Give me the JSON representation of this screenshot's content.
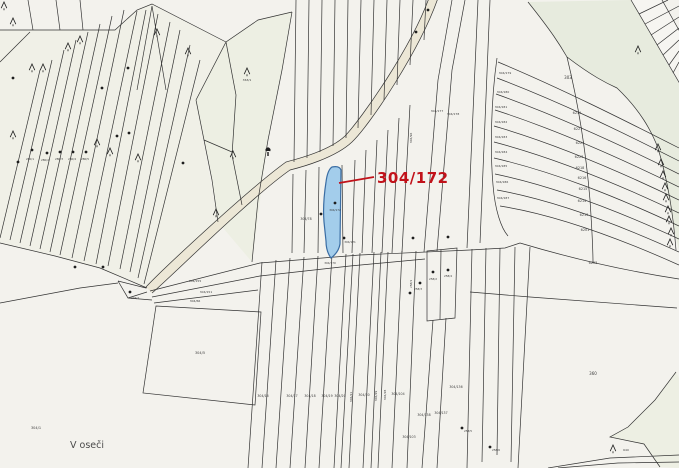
{
  "map": {
    "type": "cadastral-parcel-map",
    "place_label": "V oseči",
    "highlight": {
      "label": "304/172",
      "label_color": "#c1121a",
      "parcel_fill": "#a3cdeb",
      "parcel_stroke": "#3a6da3"
    },
    "colors": {
      "background": "#f3f2ed",
      "line": "#333333",
      "tint_green": "#e7ebde",
      "tint_green_light": "#edefe3",
      "tint_paper": "#f0f0e7",
      "road_fill": "#ece7d6",
      "label_color": "#3c3c3c"
    },
    "symbols": {
      "conifer_tree_icon": [
        [
          4,
          6
        ],
        [
          13,
          22
        ],
        [
          32,
          68
        ],
        [
          43,
          68
        ],
        [
          68,
          47
        ],
        [
          80,
          40
        ],
        [
          157,
          33
        ],
        [
          188,
          52
        ],
        [
          13,
          135
        ],
        [
          97,
          143
        ],
        [
          110,
          152
        ],
        [
          138,
          158
        ],
        [
          216,
          213
        ],
        [
          233,
          155
        ],
        [
          638,
          50
        ],
        [
          658,
          148
        ],
        [
          661,
          163
        ],
        [
          663,
          175
        ],
        [
          665,
          187
        ],
        [
          666,
          198
        ],
        [
          668,
          210
        ],
        [
          669,
          220
        ],
        [
          671,
          232
        ],
        [
          670,
          243
        ],
        [
          613,
          449
        ],
        [
          247,
          72
        ]
      ],
      "deciduous_tree_icon": [
        [
          268,
          152
        ]
      ],
      "boundary_dots": [
        [
          13,
          78
        ],
        [
          102,
          88
        ],
        [
          128,
          68
        ],
        [
          117,
          136
        ],
        [
          129,
          133
        ],
        [
          32,
          150
        ],
        [
          47,
          153
        ],
        [
          60,
          152
        ],
        [
          73,
          152
        ],
        [
          86,
          152
        ],
        [
          18,
          162
        ],
        [
          183,
          163
        ],
        [
          75,
          267
        ],
        [
          103,
          267
        ],
        [
          335,
          203
        ],
        [
          321,
          214
        ],
        [
          344,
          238
        ],
        [
          413,
          238
        ],
        [
          448,
          237
        ],
        [
          433,
          272
        ],
        [
          448,
          270
        ],
        [
          420,
          283
        ],
        [
          410,
          293
        ],
        [
          130,
          292
        ],
        [
          462,
          428
        ],
        [
          490,
          447
        ],
        [
          428,
          10
        ],
        [
          416,
          32
        ]
      ]
    },
    "parcel_labels": [
      {
        "t": "303",
        "x": 568,
        "y": 79,
        "s": 4
      },
      {
        "t": "6219",
        "x": 577,
        "y": 114,
        "s": 3.4
      },
      {
        "t": "6227",
        "x": 578,
        "y": 130,
        "s": 3.4
      },
      {
        "t": "6224",
        "x": 580,
        "y": 144,
        "s": 3.4
      },
      {
        "t": "6223",
        "x": 579,
        "y": 158,
        "s": 3.4
      },
      {
        "t": "6218",
        "x": 580,
        "y": 169,
        "s": 3.4
      },
      {
        "t": "6216",
        "x": 582,
        "y": 179,
        "s": 3.4
      },
      {
        "t": "6215",
        "x": 583,
        "y": 190,
        "s": 3.4
      },
      {
        "t": "6214",
        "x": 582,
        "y": 202,
        "s": 3.4
      },
      {
        "t": "6213",
        "x": 584,
        "y": 216,
        "s": 3.4
      },
      {
        "t": "6201",
        "x": 585,
        "y": 231,
        "s": 3.4
      },
      {
        "t": "6203",
        "x": 593,
        "y": 264,
        "s": 3.4
      },
      {
        "t": "304/179",
        "x": 505,
        "y": 74,
        "s": 3
      },
      {
        "t": "304/180",
        "x": 503,
        "y": 93,
        "s": 3
      },
      {
        "t": "304/181",
        "x": 501,
        "y": 108,
        "s": 3
      },
      {
        "t": "304/182",
        "x": 501,
        "y": 123,
        "s": 3
      },
      {
        "t": "304/183",
        "x": 501,
        "y": 138,
        "s": 3
      },
      {
        "t": "304/184",
        "x": 501,
        "y": 153,
        "s": 3
      },
      {
        "t": "304/185",
        "x": 501,
        "y": 167,
        "s": 3
      },
      {
        "t": "304/186",
        "x": 502,
        "y": 183,
        "s": 3
      },
      {
        "t": "304/187",
        "x": 503,
        "y": 199,
        "s": 3
      },
      {
        "t": "304/177",
        "x": 437,
        "y": 112,
        "s": 3
      },
      {
        "t": "304/178",
        "x": 453,
        "y": 115,
        "s": 3
      },
      {
        "t": "304/96",
        "x": 412,
        "y": 138,
        "s": 3,
        "r": -90
      },
      {
        "t": "304/16",
        "x": 263,
        "y": 397,
        "s": 3.2
      },
      {
        "t": "304/17",
        "x": 292,
        "y": 397,
        "s": 3.2
      },
      {
        "t": "304/18",
        "x": 310,
        "y": 397,
        "s": 3.2
      },
      {
        "t": "304/19",
        "x": 327,
        "y": 397,
        "s": 3.2
      },
      {
        "t": "304/20",
        "x": 340,
        "y": 397,
        "s": 3.2
      },
      {
        "t": "304/21",
        "x": 352,
        "y": 397,
        "s": 3,
        "r": -90
      },
      {
        "t": "304/30",
        "x": 364,
        "y": 396,
        "s": 3.2
      },
      {
        "t": "304/29",
        "x": 377,
        "y": 396,
        "s": 3,
        "r": -90
      },
      {
        "t": "304/28",
        "x": 386,
        "y": 395,
        "s": 3,
        "r": -90
      },
      {
        "t": "304/104",
        "x": 398,
        "y": 395,
        "s": 3.2
      },
      {
        "t": "304/136",
        "x": 456,
        "y": 388,
        "s": 3.2
      },
      {
        "t": "304/138",
        "x": 424,
        "y": 416,
        "s": 3.2
      },
      {
        "t": "304/137",
        "x": 441,
        "y": 414,
        "s": 3.2
      },
      {
        "t": "304/103",
        "x": 409,
        "y": 438,
        "s": 3.2
      },
      {
        "t": "258/2",
        "x": 433,
        "y": 280,
        "s": 2.8
      },
      {
        "t": "258/4",
        "x": 448,
        "y": 277,
        "s": 2.8
      },
      {
        "t": "258/3",
        "x": 418,
        "y": 290,
        "s": 2.8
      },
      {
        "t": "258/1",
        "x": 412,
        "y": 284,
        "s": 2.8,
        "r": -90
      },
      {
        "t": "258/5",
        "x": 468,
        "y": 432,
        "s": 2.8
      },
      {
        "t": "258/6",
        "x": 496,
        "y": 451,
        "s": 2.8
      },
      {
        "t": "304/155",
        "x": 195,
        "y": 282,
        "s": 3
      },
      {
        "t": "304/151",
        "x": 206,
        "y": 293,
        "s": 3
      },
      {
        "t": "304/66",
        "x": 195,
        "y": 302,
        "s": 3
      },
      {
        "t": "304/7",
        "x": 135,
        "y": 299,
        "s": 2.8
      },
      {
        "t": "304/5",
        "x": 200,
        "y": 354,
        "s": 3.5
      },
      {
        "t": "304/1",
        "x": 36,
        "y": 429,
        "s": 3.5
      },
      {
        "t": "360",
        "x": 593,
        "y": 375,
        "s": 4
      },
      {
        "t": "640",
        "x": 626,
        "y": 451,
        "s": 3
      },
      {
        "t": "363/1",
        "x": 247,
        "y": 81,
        "s": 3
      },
      {
        "t": "304/78",
        "x": 306,
        "y": 220,
        "s": 3.2
      },
      {
        "t": "304/172",
        "x": 335,
        "y": 211,
        "s": 2.8
      },
      {
        "t": "304/170",
        "x": 330,
        "y": 264,
        "s": 2.8
      },
      {
        "t": "304/171",
        "x": 350,
        "y": 243,
        "s": 2.8
      },
      {
        "t": "280/1",
        "x": 30,
        "y": 160,
        "s": 2.8
      },
      {
        "t": "280/2",
        "x": 45,
        "y": 161,
        "s": 2.8
      },
      {
        "t": "280/3",
        "x": 59,
        "y": 160,
        "s": 2.8
      },
      {
        "t": "280/4",
        "x": 72,
        "y": 160,
        "s": 2.8
      },
      {
        "t": "280/5",
        "x": 85,
        "y": 160,
        "s": 2.8
      }
    ]
  }
}
